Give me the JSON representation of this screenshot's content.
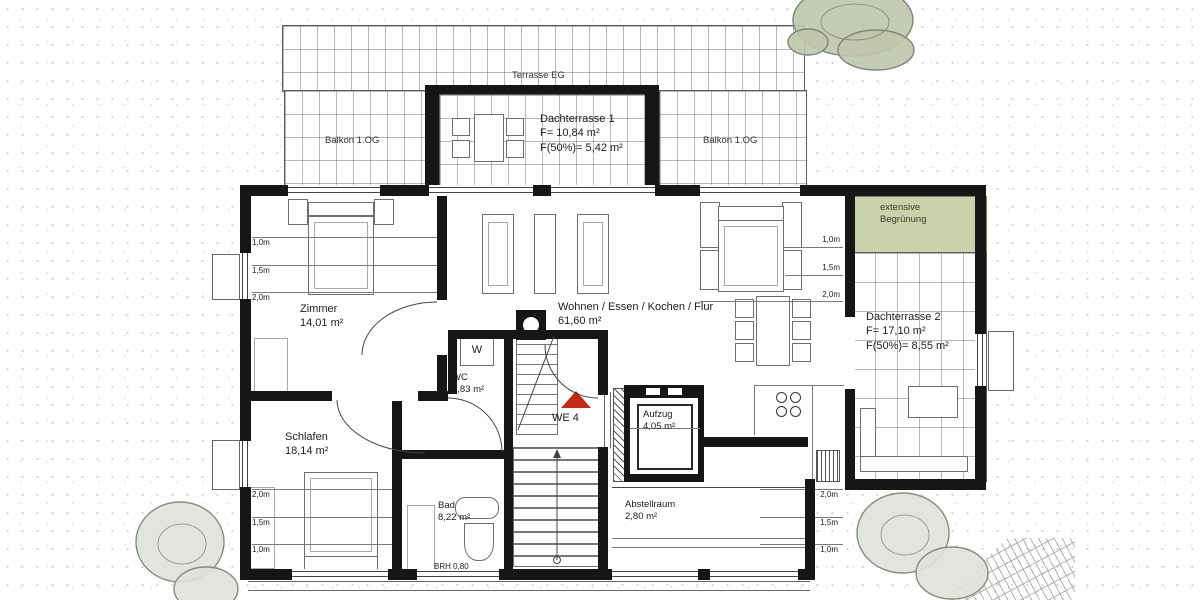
{
  "areas": {
    "terrasse_eg": {
      "label": "Terrasse EG"
    },
    "balkon_left": {
      "label": "Balkon 1.OG"
    },
    "balkon_right": {
      "label": "Balkon 1.OG"
    },
    "dachterrasse_1": {
      "label": "Dachterrasse 1",
      "area": "F= 10,84 m²",
      "area50": "F(50%)= 5,42 m²"
    },
    "dachterrasse_2": {
      "label": "Dachterrasse 2",
      "area": "F= 17,10 m²",
      "area50": "F(50%)= 8,55 m²"
    },
    "gruendach": {
      "line1": "extensive",
      "line2": "Begrünung"
    }
  },
  "rooms": {
    "zimmer": {
      "label": "Zimmer",
      "area": "14,01 m²"
    },
    "schlafen": {
      "label": "Schlafen",
      "area": "18,14 m²"
    },
    "wc": {
      "label": "WC",
      "area": "3,83 m²"
    },
    "bad": {
      "label": "Bad",
      "area": "8,22 m²"
    },
    "wohnen": {
      "label": "Wohnen / Essen / Kochen / Flur",
      "area": "61,60 m²"
    },
    "aufzug": {
      "label": "Aufzug",
      "area": "4,05 m²"
    },
    "abstellraum": {
      "label": "Abstellraum",
      "area": "2,80 m²"
    }
  },
  "unit": {
    "label": "WE 4"
  },
  "annotations": {
    "brh": "BRH 0,80",
    "washer": "W"
  },
  "height_marks": {
    "left_top": [
      "1,0m",
      "1,5m",
      "2,0m"
    ],
    "left_bottom": [
      "2,0m",
      "1,5m",
      "1,0m"
    ],
    "right_top": [
      "1,0m",
      "1,5m",
      "2,0m"
    ],
    "right_bottom": [
      "2,0m",
      "1,5m",
      "1,0m"
    ]
  },
  "colors": {
    "wall": "#161616",
    "green_roof": "#c9d2ab",
    "unit_red": "#c62817",
    "tree_fill": "#ccd1bf",
    "tree_fill_dark": "#bfc7ac",
    "tree_stroke": "#7f8574"
  }
}
